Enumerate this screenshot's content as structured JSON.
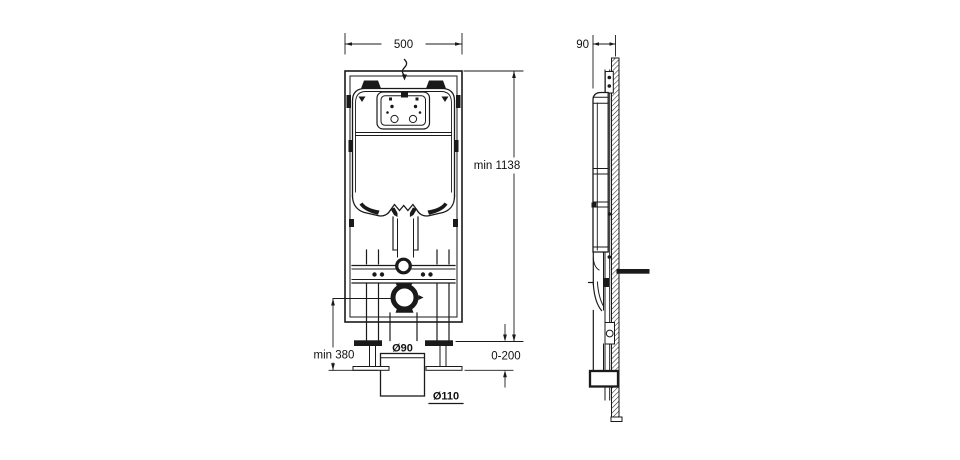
{
  "canvas": {
    "background": "#ffffff",
    "ink": "#1a1a1a"
  },
  "drawing_type": "wc-frame-installation-diagram",
  "front_view": {
    "dim_width": "500",
    "dim_height": "min 1138",
    "dim_outlet_height": "min 380",
    "dim_outlet_pipe": "Ø90",
    "dim_leg_adjust": "0-200",
    "dim_drain_pipe": "Ø110"
  },
  "side_view": {
    "dim_depth": "90"
  }
}
